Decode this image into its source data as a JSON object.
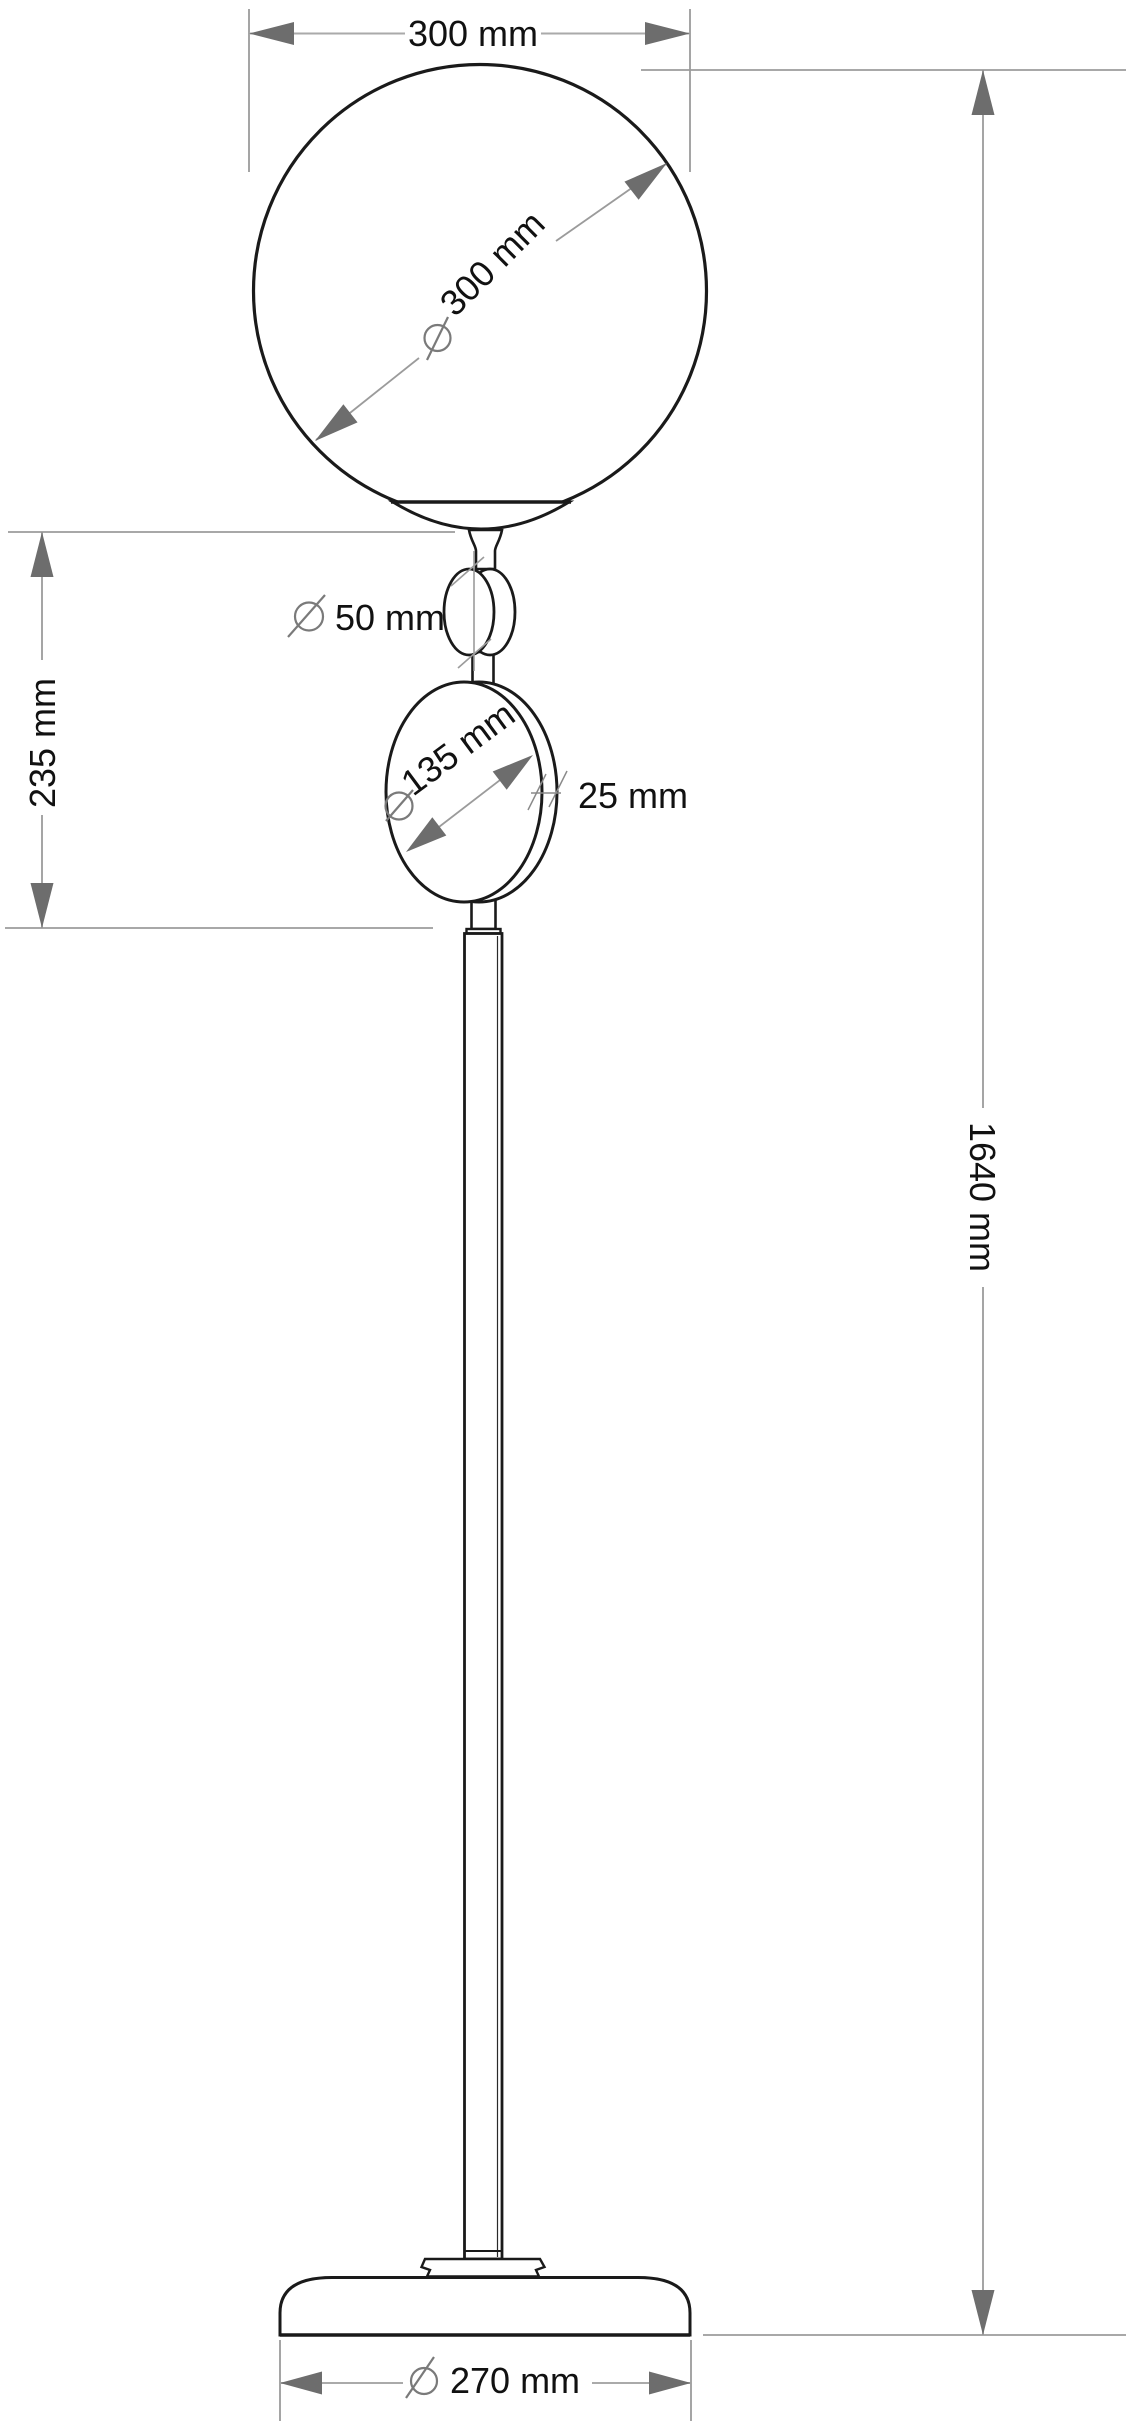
{
  "drawing": {
    "subject": "floor-lamp-dimensional-drawing",
    "labels": {
      "globe_width": "300 mm",
      "globe_diameter": "300 mm",
      "ball_diameter": "50 mm",
      "disc_diameter": "135 mm",
      "disc_thickness": "25 mm",
      "upper_section_height": "235 mm",
      "total_height": "1640 mm",
      "base_diameter": "270 mm"
    },
    "symbols": {
      "diameter_sign": "Ø"
    },
    "colors": {
      "outline": "#1a1a1a",
      "dimension_line": "#9b9b9b",
      "arrowhead": "#6d6d6d",
      "diameter_symbol": "#7a7a7a",
      "label_text": "#111111",
      "background": "#ffffff"
    }
  }
}
